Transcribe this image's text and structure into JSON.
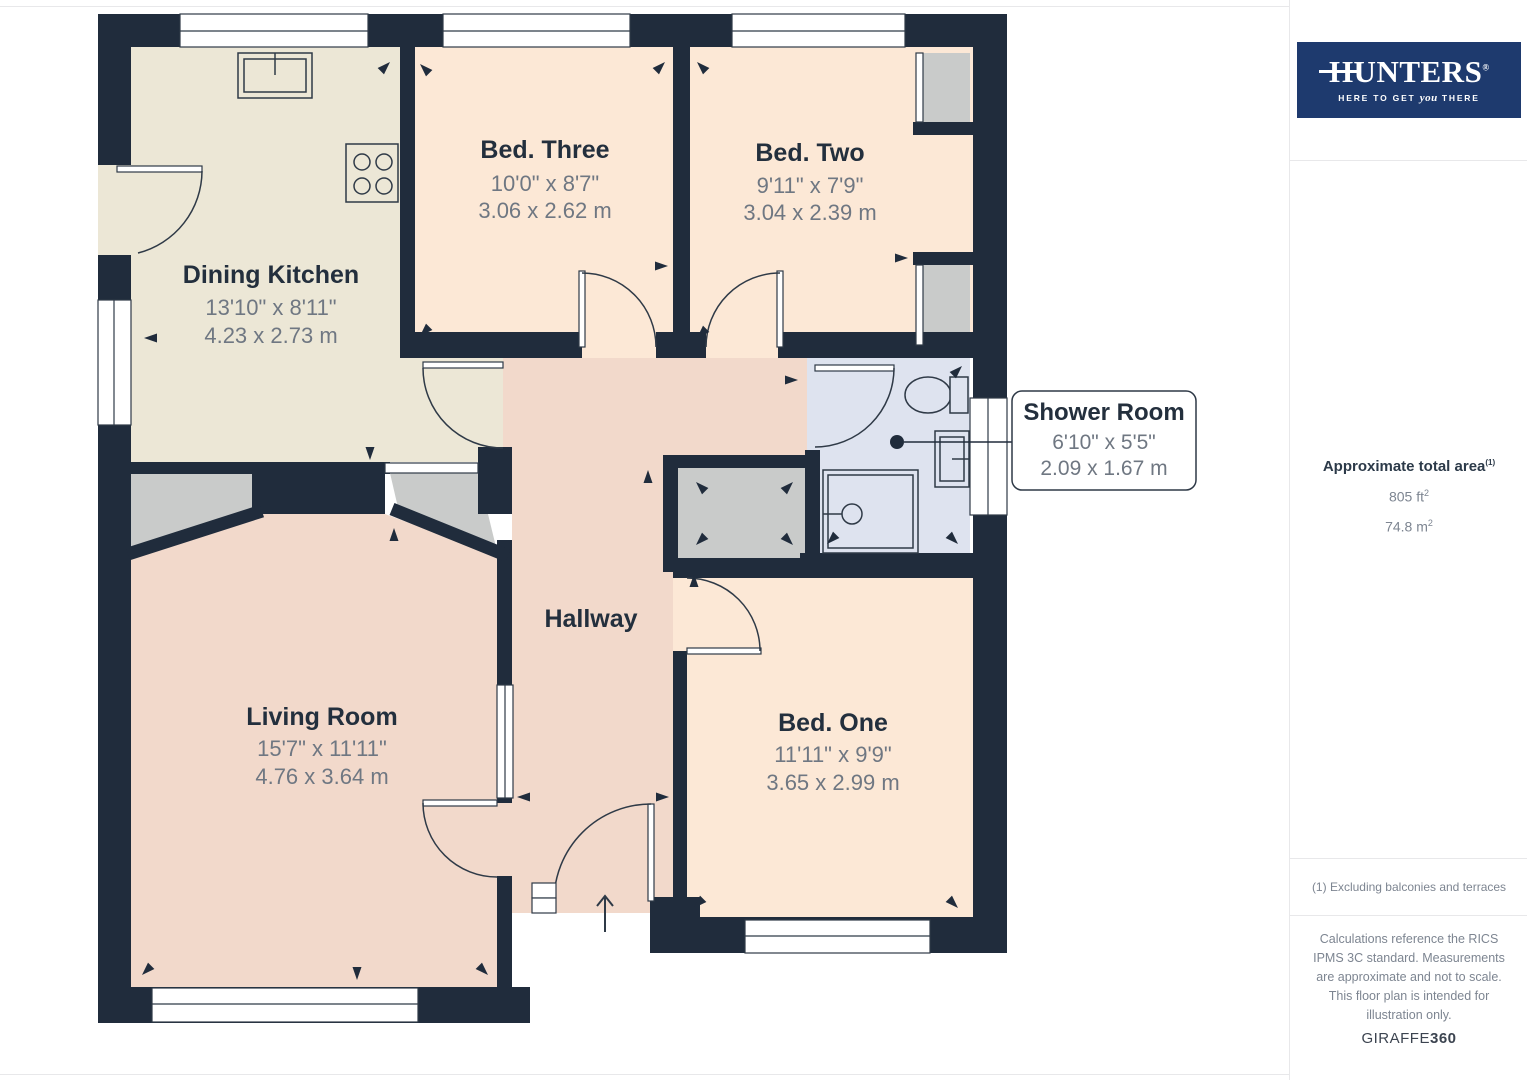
{
  "floorplan": {
    "rooms": [
      {
        "id": "dining-kitchen",
        "name": "Dining Kitchen",
        "imperial": "13'10\" x 8'11\"",
        "metric": "4.23 x 2.73 m"
      },
      {
        "id": "bed-three",
        "name": "Bed. Three",
        "imperial": "10'0\" x 8'7\"",
        "metric": "3.06 x 2.62 m"
      },
      {
        "id": "bed-two",
        "name": "Bed. Two",
        "imperial": "9'11\" x 7'9\"",
        "metric": "3.04 x 2.39 m"
      },
      {
        "id": "shower-room",
        "name": "Shower Room",
        "imperial": "6'10\" x 5'5\"",
        "metric": "2.09 x 1.67 m"
      },
      {
        "id": "hallway",
        "name": "Hallway"
      },
      {
        "id": "living-room",
        "name": "Living Room",
        "imperial": "15'7\" x 11'11\"",
        "metric": "4.76 x 3.64 m"
      },
      {
        "id": "bed-one",
        "name": "Bed. One",
        "imperial": "11'11\" x 9'9\"",
        "metric": "3.65 x 2.99 m"
      }
    ],
    "colors": {
      "wall": "#202c3c",
      "kitchen_floor": "#ece7d6",
      "bedroom_floor": "#fce8d6",
      "hall_living_floor": "#f2d9cb",
      "shower_floor": "#dee3ef",
      "cupboard_gray": "#c9cbca",
      "line": "#2f3a47"
    }
  },
  "sidebar": {
    "logo": {
      "brand": "HUNTERS",
      "registered": "®",
      "tagline_pre": "HERE TO GET",
      "tagline_emph": "you",
      "tagline_post": "THERE"
    },
    "area": {
      "label": "Approximate total area",
      "footnote_marker": "(1)",
      "imperial_value": "805 ft",
      "imperial_sup": "2",
      "metric_value": "74.8 m",
      "metric_sup": "2"
    },
    "footnote": "(1) Excluding balconies and terraces",
    "disclaimer": "Calculations reference the RICS IPMS 3C standard. Measurements are approximate and not to scale. This floor plan is intended for illustration only.",
    "brand_footer": {
      "name": "GIRAFFE",
      "suffix": "360"
    }
  }
}
